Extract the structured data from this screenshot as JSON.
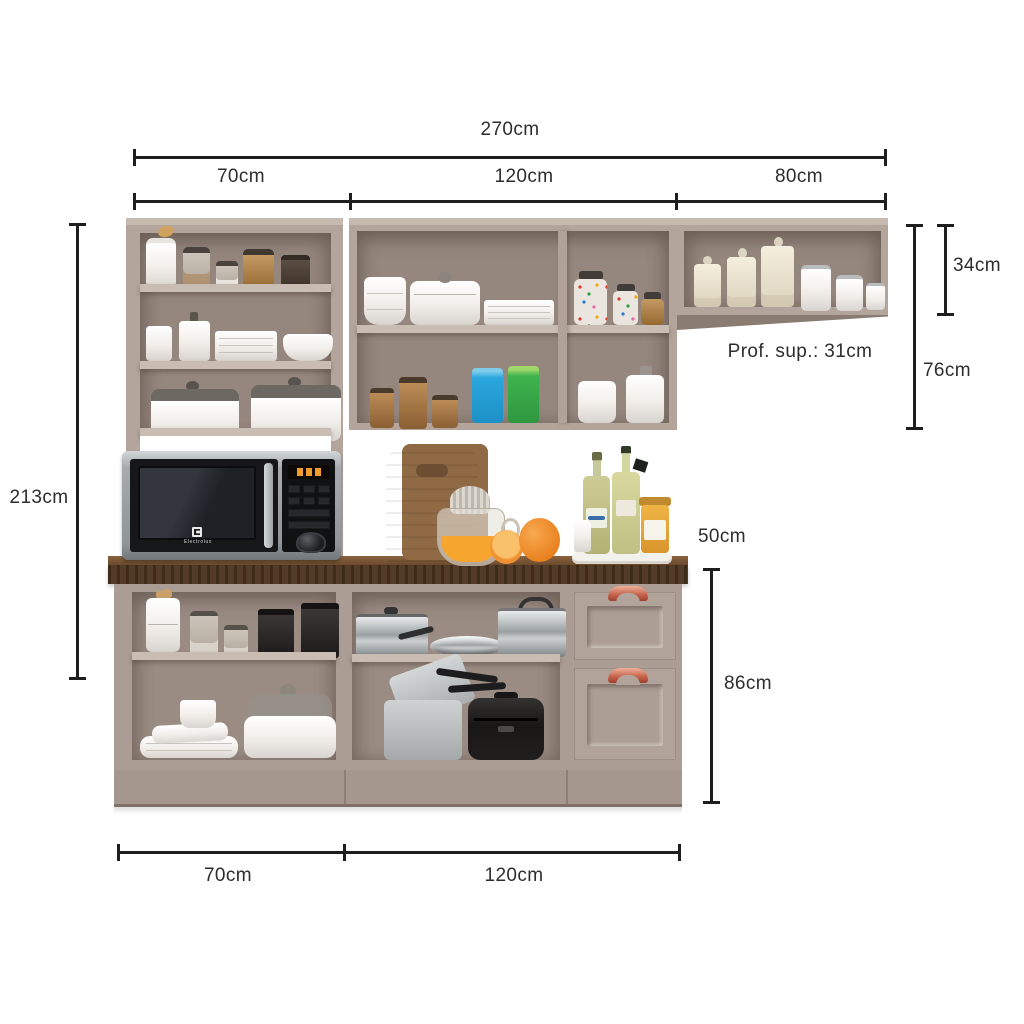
{
  "annotations": {
    "total_width": "270cm",
    "seg_left": "70cm",
    "seg_mid": "120cm",
    "seg_right": "80cm",
    "height_total": "213cm",
    "hutch_height": "34cm",
    "upper_height": "76cm",
    "upper_depth": "Prof. sup.: 31cm",
    "counter_module_width": "50cm",
    "base_height": "86cm",
    "base_left_width": "70cm",
    "base_mid_width": "120cm"
  },
  "microwave": {
    "brand": "Electrolux"
  },
  "colors": {
    "background": "#ffffff",
    "dimension_line": "#1e1e1e",
    "label_text": "#2d2d2d",
    "cabinet_frame": "#b3a59c",
    "cabinet_interior": "#95877e",
    "shelf_edge": "#c9bcb3",
    "countertop_wood": "#4c3521",
    "drawer_handle_copper": "#c4614a",
    "microwave_silver": "#9aa0a3",
    "microwave_black": "#151719",
    "display_orange": "#ef9d2e",
    "blue_cup": "#2aa7de",
    "green_cup": "#3eb34d",
    "orange_fruit": "#ef8f28"
  },
  "scene": {
    "tall_cabinet": [
      "storage jars",
      "white canisters, plates and bowls",
      "two casserole dishes",
      "microwave niche"
    ],
    "middle_wall_cabinet": [
      "bowl stack, casserole and plates",
      "candy jars",
      "wooden canisters, blue and green cups",
      "white containers"
    ],
    "right_wall_cabinet": [
      "ceramic canisters and clip-top jars"
    ],
    "countertop": [
      "cutting boards",
      "citrus juicer with juice",
      "oranges",
      "tray with oil bottles, salt and honey jar"
    ],
    "base_cabinet": [
      "jars and black canisters",
      "square plates, cup and casserole",
      "stainless pots and frying pan",
      "aluminium pots and rice cooker",
      "two drawers with copper handles"
    ]
  }
}
